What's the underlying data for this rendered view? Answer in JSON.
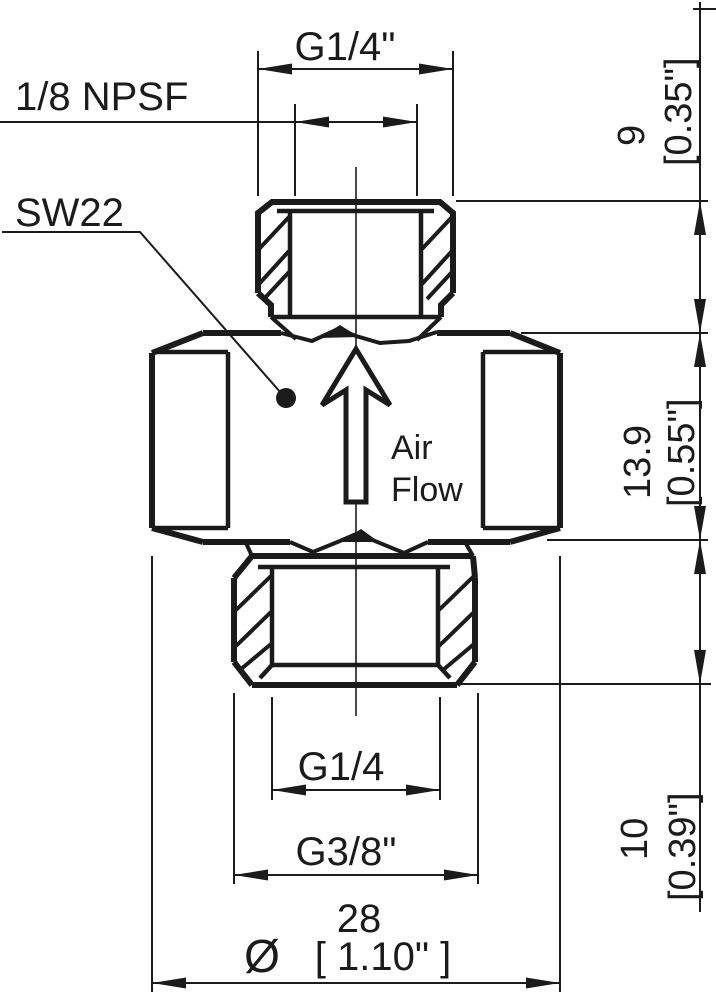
{
  "drawing": {
    "part_labels": {
      "inner_thread": "1/8 NPSF",
      "wrench_size": "SW22",
      "air_flow_line1": "Air",
      "air_flow_line2": "Flow"
    },
    "dimensions": {
      "top_thread": "G1/4\"",
      "right_top": {
        "mm": "9",
        "inch": "[0.35\"]"
      },
      "right_middle": {
        "mm": "13.9",
        "inch": "[0.55\"]"
      },
      "right_bottom": {
        "mm": "10",
        "inch": "[0.39\"]"
      },
      "bottom_thread_inner": "G1/4",
      "bottom_thread_outer": "G3/8\"",
      "body_width": {
        "symbol": "Ø",
        "mm": "28",
        "inch": "[ 1.10\" ]"
      }
    },
    "colors": {
      "line": "#1b1b1b",
      "background": "#ffffff"
    }
  }
}
